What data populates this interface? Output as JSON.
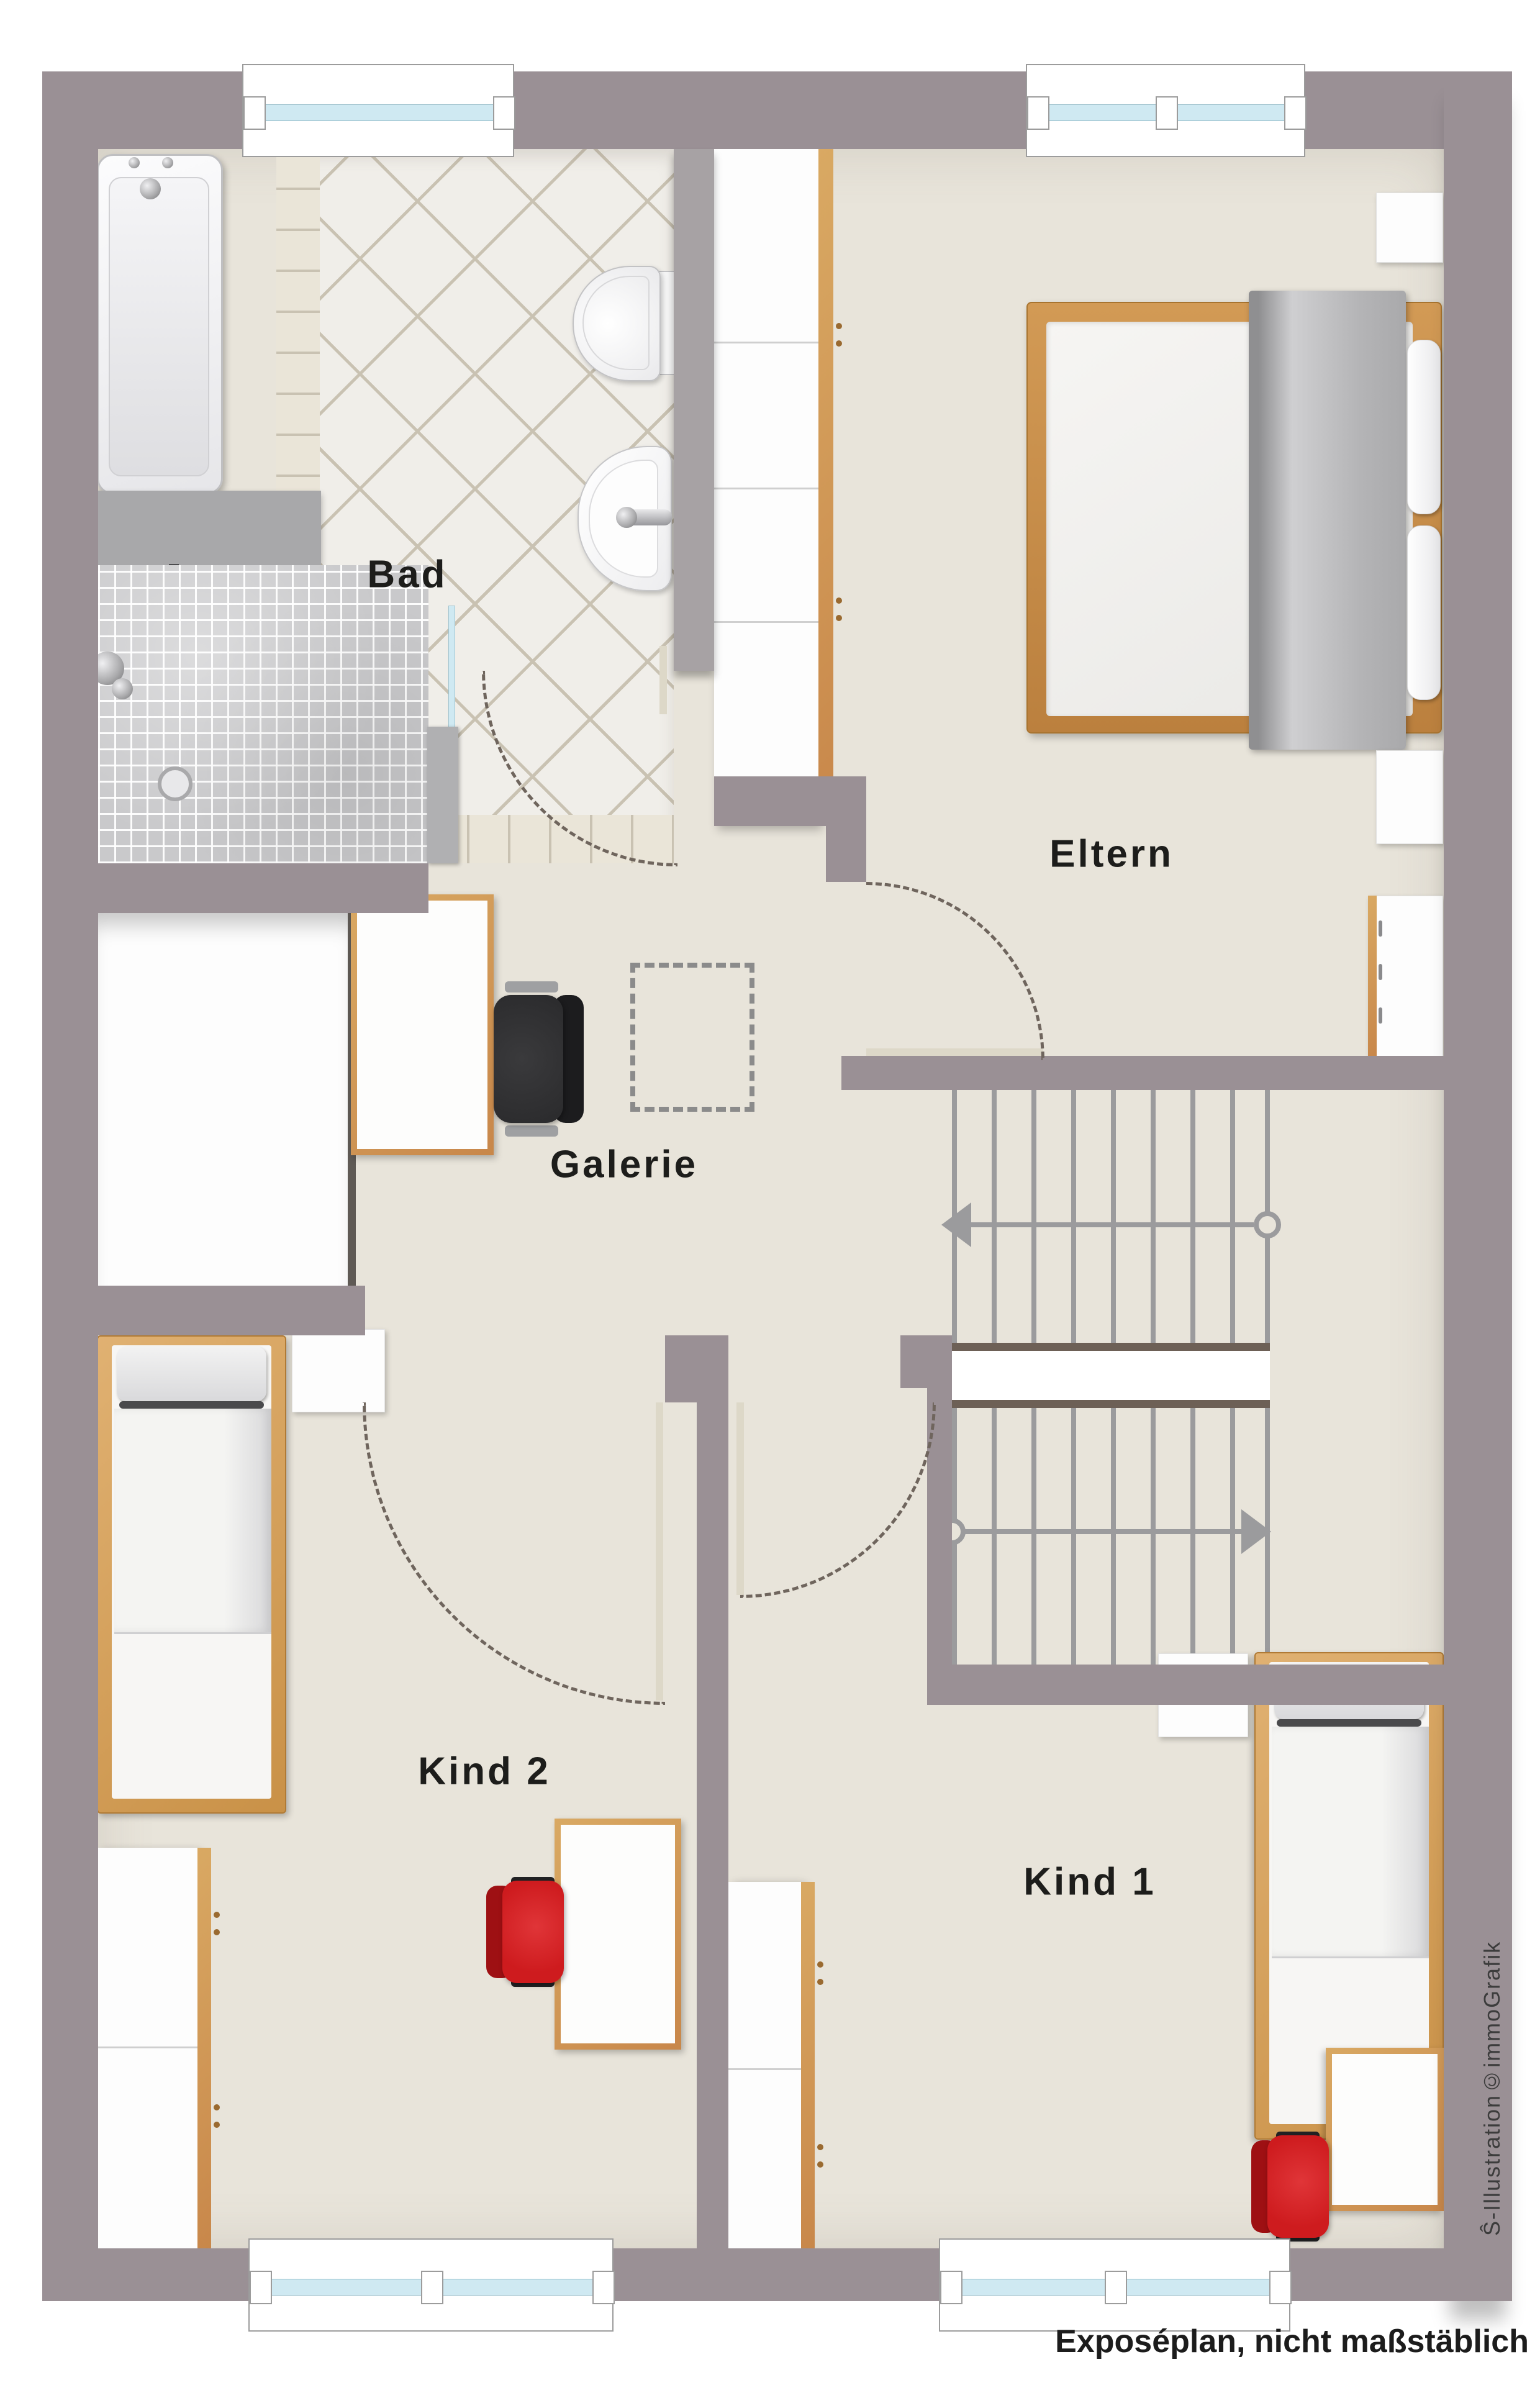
{
  "rooms": {
    "bad": {
      "label": "Bad"
    },
    "eltern": {
      "label": "Eltern"
    },
    "galerie": {
      "label": "Galerie"
    },
    "kind2": {
      "label": "Kind 2"
    },
    "kind1": {
      "label": "Kind 1"
    }
  },
  "captions": {
    "disclaimer": "Exposéplan, nicht maßstäblich",
    "credit": "Ŝ-Illustration©immoGrafik"
  },
  "colors": {
    "wall": "#9a9095",
    "wall-light": "#a7a2a4",
    "floor": "#e8e4da",
    "tile": "#f0eee9",
    "tile-line": "#c9c2b2",
    "glass": "#cfe9f2",
    "wood": "#c8874a",
    "wood-light": "#d9a963",
    "chair-red": "#ce1b1e",
    "chair-dark-red": "#9e1013",
    "chair-black": "#2a2a2c",
    "blanket": "#b9b9bb",
    "stair-line": "#9b9b9d",
    "landing-border": "#6d6056",
    "arc": "#6f655d",
    "mosaic": "#c9c9cb",
    "label": "#1d1d1b",
    "credit": "#3c3c3c"
  }
}
